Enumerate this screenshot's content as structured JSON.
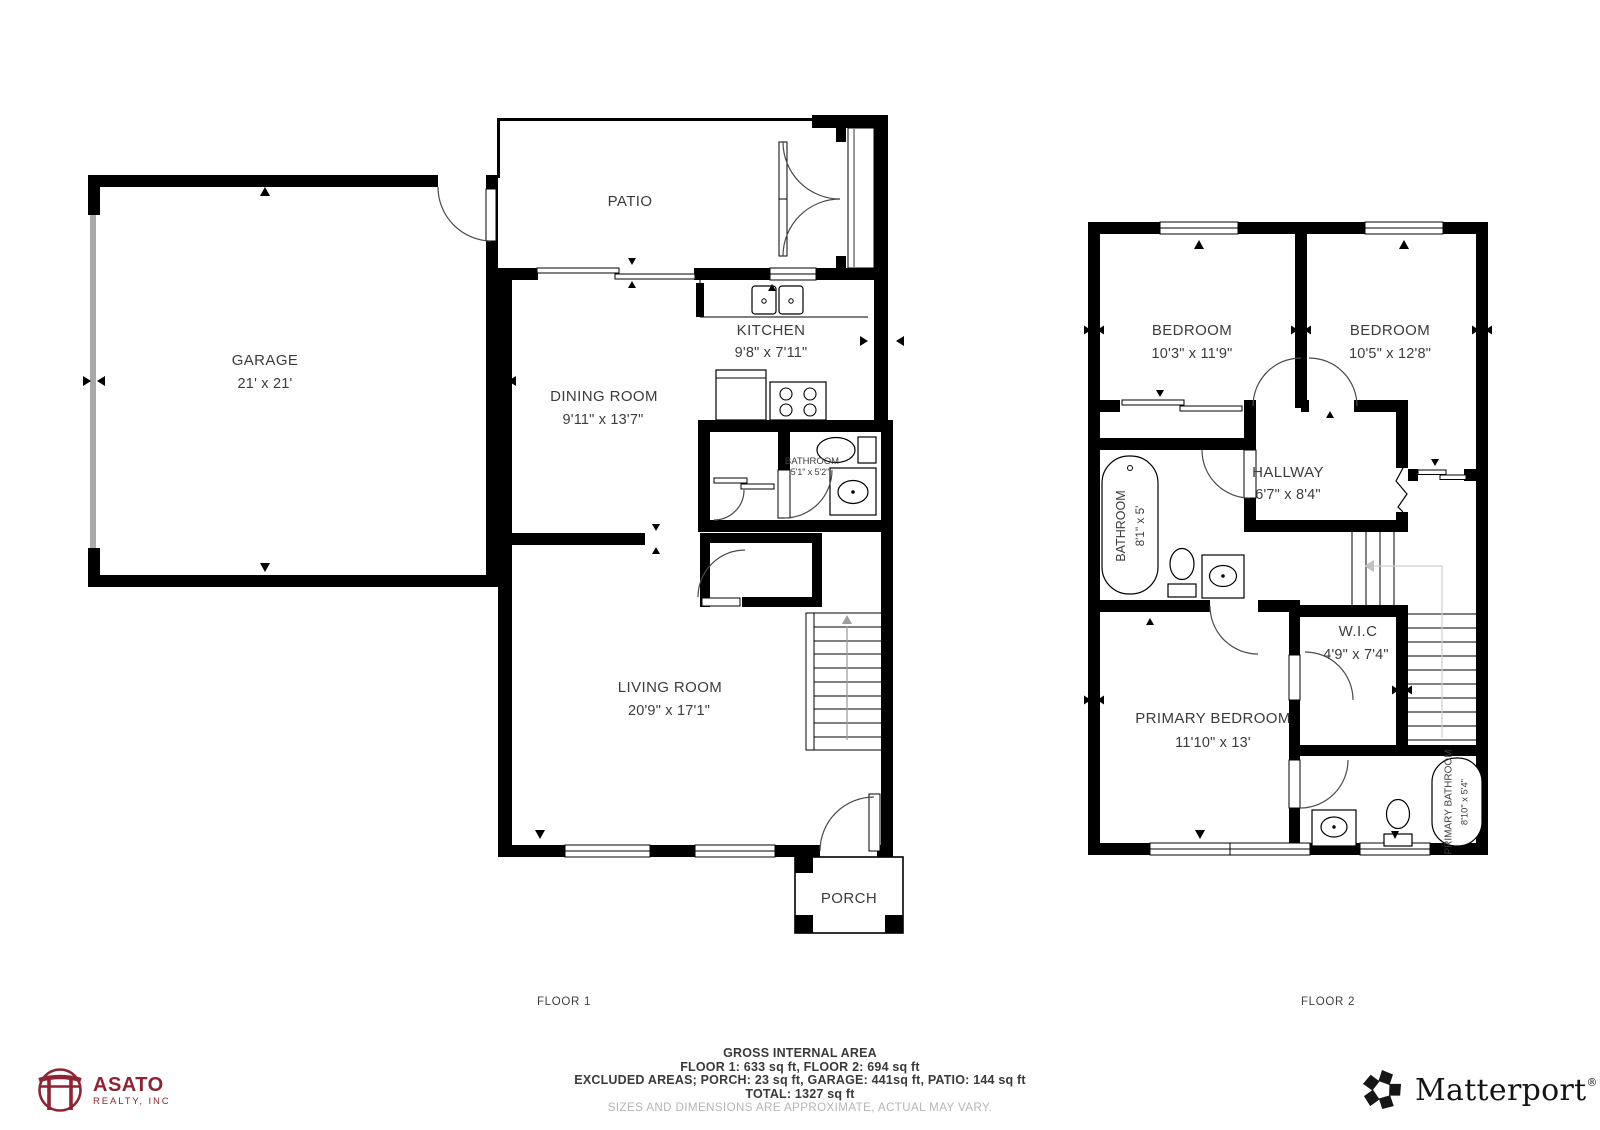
{
  "canvas": {
    "width": 1600,
    "height": 1130,
    "background": "#ffffff"
  },
  "colors": {
    "wall": "#000000",
    "label": "#3c3c3c",
    "disclaimer_gray": "#b5b5b5",
    "stair_guide_gray": "#cfcfcf",
    "asato_maroon": "#8e2433",
    "matterport_black": "#141414"
  },
  "floor1": {
    "caption": "FLOOR 1",
    "rooms": {
      "patio": {
        "name": "PATIO"
      },
      "garage": {
        "name": "GARAGE",
        "dims": "21' x 21'"
      },
      "kitchen": {
        "name": "KITCHEN",
        "dims": "9'8\" x 7'11\""
      },
      "dining_room": {
        "name": "DINING ROOM",
        "dims": "9'11\" x 13'7\""
      },
      "bathroom": {
        "name": "BATHROOM",
        "dims": "5'1\" x 5'2\""
      },
      "living_room": {
        "name": "LIVING ROOM",
        "dims": "20'9\" x 17'1\""
      },
      "porch": {
        "name": "PORCH"
      }
    }
  },
  "floor2": {
    "caption": "FLOOR 2",
    "rooms": {
      "bedroom_left": {
        "name": "BEDROOM",
        "dims": "10'3\" x 11'9\""
      },
      "bedroom_right": {
        "name": "BEDROOM",
        "dims": "10'5\" x 12'8\""
      },
      "hallway": {
        "name": "HALLWAY",
        "dims": "6'7\" x 8'4\""
      },
      "bathroom": {
        "name": "BATHROOM",
        "dims": "8'1\" x 5'"
      },
      "wic": {
        "name": "W.I.C",
        "dims": "4'9\" x 7'4\""
      },
      "primary_bedroom": {
        "name": "PRIMARY BEDROOM",
        "dims": "11'10\" x 13'"
      },
      "primary_bathroom": {
        "name": "PRIMARY BATHROOM",
        "dims": "8'10\" x 5'4\""
      }
    }
  },
  "footer": {
    "title": "GROSS INTERNAL AREA",
    "line1": "FLOOR 1: 633 sq ft, FLOOR 2: 694 sq ft",
    "line2": "EXCLUDED AREAS; PORCH: 23 sq ft, GARAGE: 441sq ft, PATIO: 144 sq ft",
    "line3": "TOTAL: 1327 sq ft",
    "disclaimer": "SIZES AND DIMENSIONS ARE APPROXIMATE, ACTUAL MAY VARY."
  },
  "branding": {
    "asato": {
      "name": "ASATO",
      "subtitle": "REALTY, INC",
      "icon": "torii-gate-icon",
      "color": "#8e2433"
    },
    "matterport": {
      "name": "Matterport",
      "registered": "®",
      "icon": "pinwheel-icon"
    }
  }
}
